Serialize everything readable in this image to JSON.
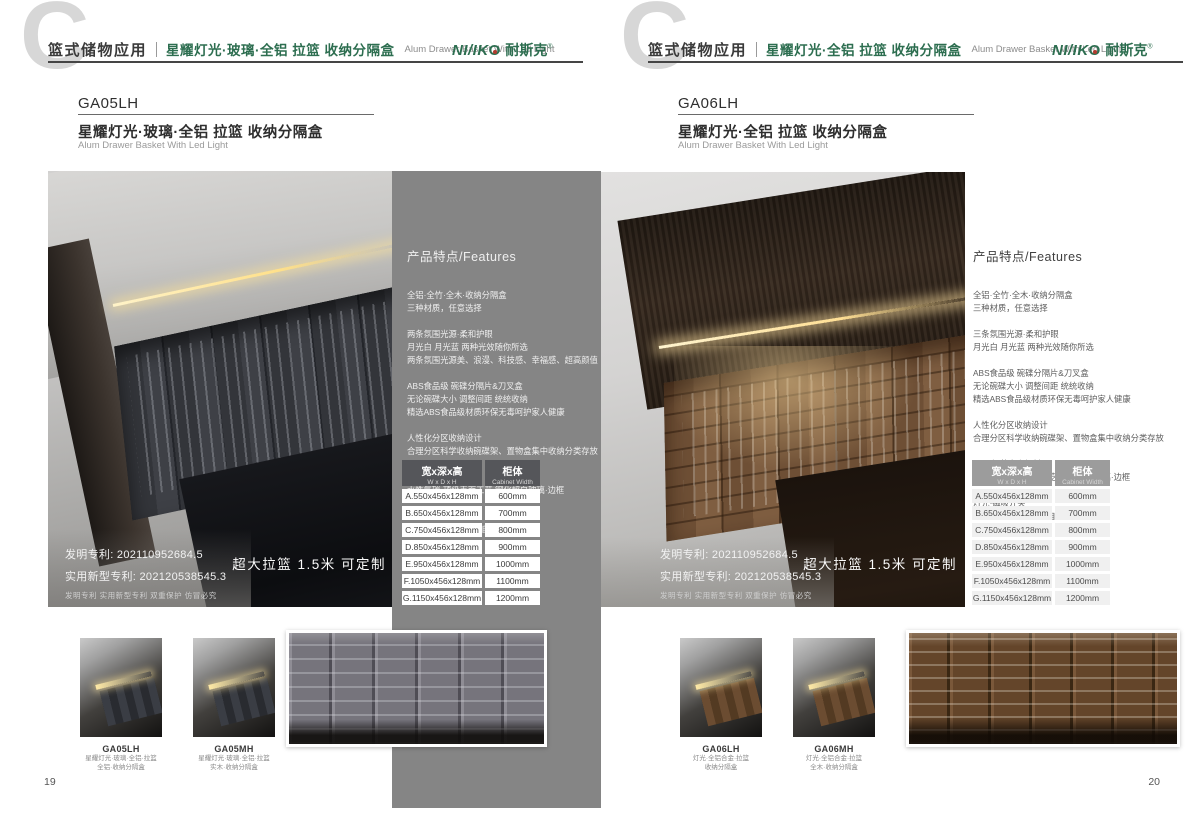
{
  "brand": {
    "latin": "NI/IK",
    "o": "O",
    "cn": "耐斯克",
    "reg": "®"
  },
  "pages": [
    {
      "page_number": "19",
      "header": {
        "watermark": "C",
        "category": "篮式储物应用",
        "title_cn": "星耀灯光·玻璃·全铝 拉篮 收纳分隔盒",
        "title_en": "Alum Drawer Basket With Led Light"
      },
      "product": {
        "code": "GA05LH",
        "name_cn": "星耀灯光·玻璃·全铝 拉篮 收纳分隔盒",
        "name_en": "Alum Drawer Basket With Led Light"
      },
      "features": {
        "heading": "产品特点/Features",
        "groups": [
          "全铝·全竹·全木·收纳分隔盒\n三种材质，任意选择",
          "两条氛围光源·柔和护眼\n月光白 月光蓝 两种光效随你所选\n两条氛围光源美、浪漫、科技感、幸福感、超高颜值",
          "ABS食品级 碗碟分隔片&刀叉盒\n无论碗碟大小 调整间距 统统收纳\n精选ABS食品级材质环保无毒呵护家人健康",
          "人性化分区收纳设计\n合理分区科学收纳碗碟架、置物盒集中收纳分类存放",
          "5MM轻薄太空铝材\n水性氟碳·顶级表面工艺 钢化超白玻璃·边框",
          "灯光·磁吸开关\n拉出·灯亮起 关闭·灯自熄"
        ]
      },
      "patent": {
        "line1": "发明专利: 202110952684.5",
        "line2": "实用新型专利: 202120538545.3",
        "line3": "发明专利 实用新型专利 双重保护 仿冒必究"
      },
      "badge": "超大拉篮 1.5米 可定制",
      "table": {
        "size_cn": "宽x深x高",
        "size_en": "W x D x H",
        "cab_cn": "柜体",
        "cab_en": "Cabinet Width",
        "rows": [
          {
            "size": "A.550x456x128mm",
            "cab": "600mm"
          },
          {
            "size": "B.650x456x128mm",
            "cab": "700mm"
          },
          {
            "size": "C.750x456x128mm",
            "cab": "800mm"
          },
          {
            "size": "D.850x456x128mm",
            "cab": "900mm"
          },
          {
            "size": "E.950x456x128mm",
            "cab": "1000mm"
          },
          {
            "size": "F.1050x456x128mm",
            "cab": "1100mm"
          },
          {
            "size": "G.1150x456x128mm",
            "cab": "1200mm"
          }
        ]
      },
      "thumbs": [
        {
          "code": "GA05LH",
          "line1": "星耀灯光·玻璃·全铝·拉篮",
          "line2": "全铝·收纳分隔盒"
        },
        {
          "code": "GA05MH",
          "line1": "星耀灯光·玻璃·全铝·拉篮",
          "line2": "实木·收纳分隔盒"
        }
      ]
    },
    {
      "page_number": "20",
      "header": {
        "watermark": "C",
        "category": "篮式储物应用",
        "title_cn": "星耀灯光·全铝 拉篮 收纳分隔盒",
        "title_en": "Alum Drawer Basket With Led Light"
      },
      "product": {
        "code": "GA06LH",
        "name_cn": "星耀灯光·全铝 拉篮 收纳分隔盒",
        "name_en": "Alum Drawer Basket With Led Light"
      },
      "features": {
        "heading": "产品特点/Features",
        "groups": [
          "全铝·全竹·全木·收纳分隔盒\n三种材质，任意选择",
          "三条氛围光源·柔和护眼\n月光白 月光蓝 两种光效随你所选",
          "ABS食品级 碗碟分隔片&刀叉盒\n无论碗碟大小 调整间距 统统收纳\n精选ABS食品级材质环保无毒呵护家人健康",
          "人性化分区收纳设计\n合理分区科学收纳碗碟架、置物盒集中收纳分类存放",
          "5MM轻薄太空铝材\n水性氟碳·顶级表面工艺 钢化超白玻璃·边框",
          "灯光·磁吸开关\n拉出·灯亮起 关闭·灯自熄"
        ]
      },
      "patent": {
        "line1": "发明专利: 202110952684.5",
        "line2": "实用新型专利: 202120538545.3",
        "line3": "发明专利 实用新型专利 双重保护 仿冒必究"
      },
      "badge": "超大拉篮 1.5米 可定制",
      "table": {
        "size_cn": "宽x深x高",
        "size_en": "W x D x H",
        "cab_cn": "柜体",
        "cab_en": "Cabinet Width",
        "rows": [
          {
            "size": "A.550x456x128mm",
            "cab": "600mm"
          },
          {
            "size": "B.650x456x128mm",
            "cab": "700mm"
          },
          {
            "size": "C.750x456x128mm",
            "cab": "800mm"
          },
          {
            "size": "D.850x456x128mm",
            "cab": "900mm"
          },
          {
            "size": "E.950x456x128mm",
            "cab": "1000mm"
          },
          {
            "size": "F.1050x456x128mm",
            "cab": "1100mm"
          },
          {
            "size": "G.1150x456x128mm",
            "cab": "1200mm"
          }
        ]
      },
      "thumbs": [
        {
          "code": "GA06LH",
          "line1": "灯光·全铝合金·拉篮",
          "line2": "收纳分隔盒"
        },
        {
          "code": "GA06MH",
          "line1": "灯光·全铝合金·拉篮",
          "line2": "全木·收纳分隔盒"
        }
      ]
    }
  ],
  "colors": {
    "brand_green": "#2d6e50",
    "panel_gray": "#858585",
    "table_header_dark": "#55565a",
    "table_header_light": "#9c9c9c",
    "led_glow": "#ffe08a"
  }
}
